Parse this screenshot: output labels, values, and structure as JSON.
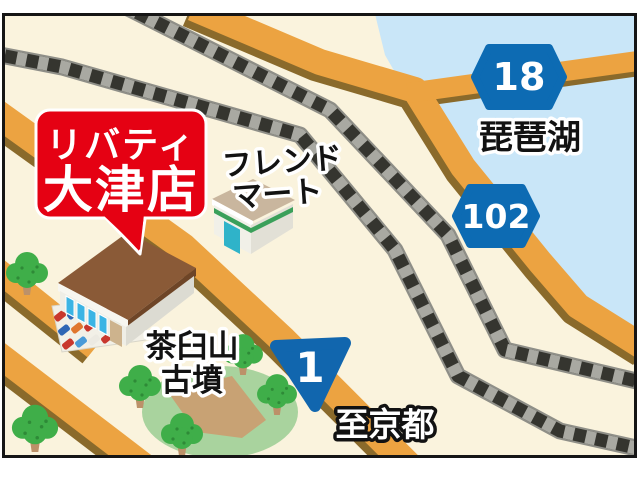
{
  "map": {
    "callout": {
      "line1": "リバティ",
      "line2": "大津店",
      "bg_color": "#e50113",
      "text_color": "#ffffff"
    },
    "landmarks": {
      "friend_mart_line1": "フレンド",
      "friend_mart_line2": "マート",
      "lake_name": "琵琶湖",
      "kofun_line1": "茶臼山",
      "kofun_line2": "古墳",
      "to_kyoto": "至京都"
    },
    "route_badges": {
      "route18": "18",
      "route102": "102",
      "route1": "1",
      "badge_color": "#0d6bb3"
    },
    "colors": {
      "land": "#faf3dd",
      "water": "#c9e6f8",
      "road": "#eca341",
      "road_shadow": "#8a6a2b",
      "rail_dark": "#35352f",
      "rail_light": "#a9a9a2",
      "tree_green": "#3fae49",
      "mound_green": "#a9d39e",
      "mound_path": "#c8a274",
      "roof_brown": "#8a5a37"
    }
  }
}
